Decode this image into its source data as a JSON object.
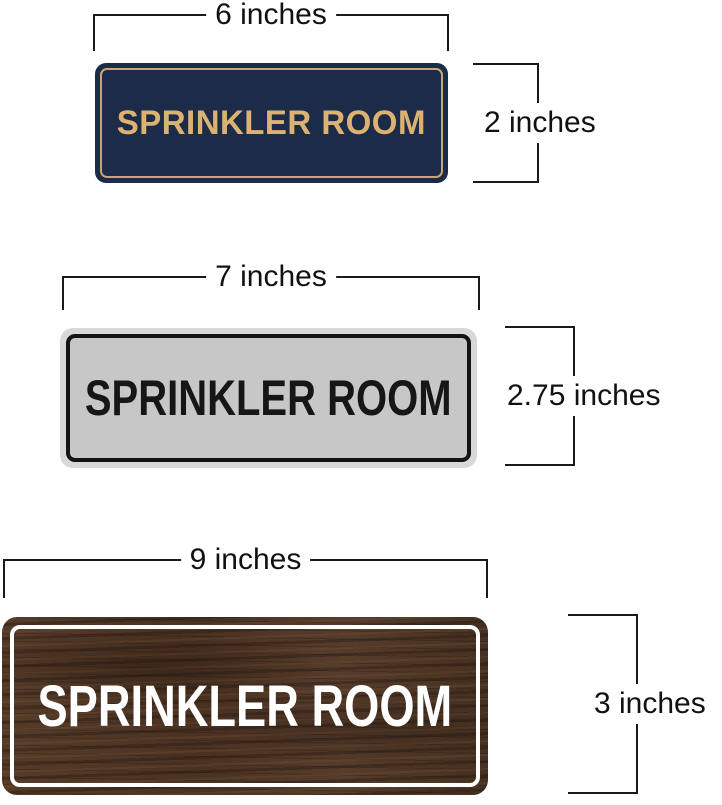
{
  "page": {
    "background_color": "#ffffff",
    "dimension_line_color": "#1a1a1a",
    "dimension_label_color": "#111111"
  },
  "signs": [
    {
      "id": "navy-gold-sign",
      "text": "SPRINKLER ROOM",
      "width_label": "6 inches",
      "height_label": "2 inches",
      "colors": {
        "background": "#1c2b47",
        "inner_border": "#c9a76a",
        "text": "#dcb273"
      }
    },
    {
      "id": "silver-black-sign",
      "text": "SPRINKLER ROOM",
      "width_label": "7 inches",
      "height_label": "2.75 inches",
      "colors": {
        "rim": "#d8d8d8",
        "background": "#c7c7c7",
        "inner_border": "#141414",
        "text": "#161616"
      }
    },
    {
      "id": "walnut-white-sign",
      "text": "SPRINKLER ROOM",
      "width_label": "9 inches",
      "height_label": "3 inches",
      "colors": {
        "background": "#4b3425",
        "inner_border": "#ffffff",
        "text": "#ffffff"
      }
    }
  ]
}
